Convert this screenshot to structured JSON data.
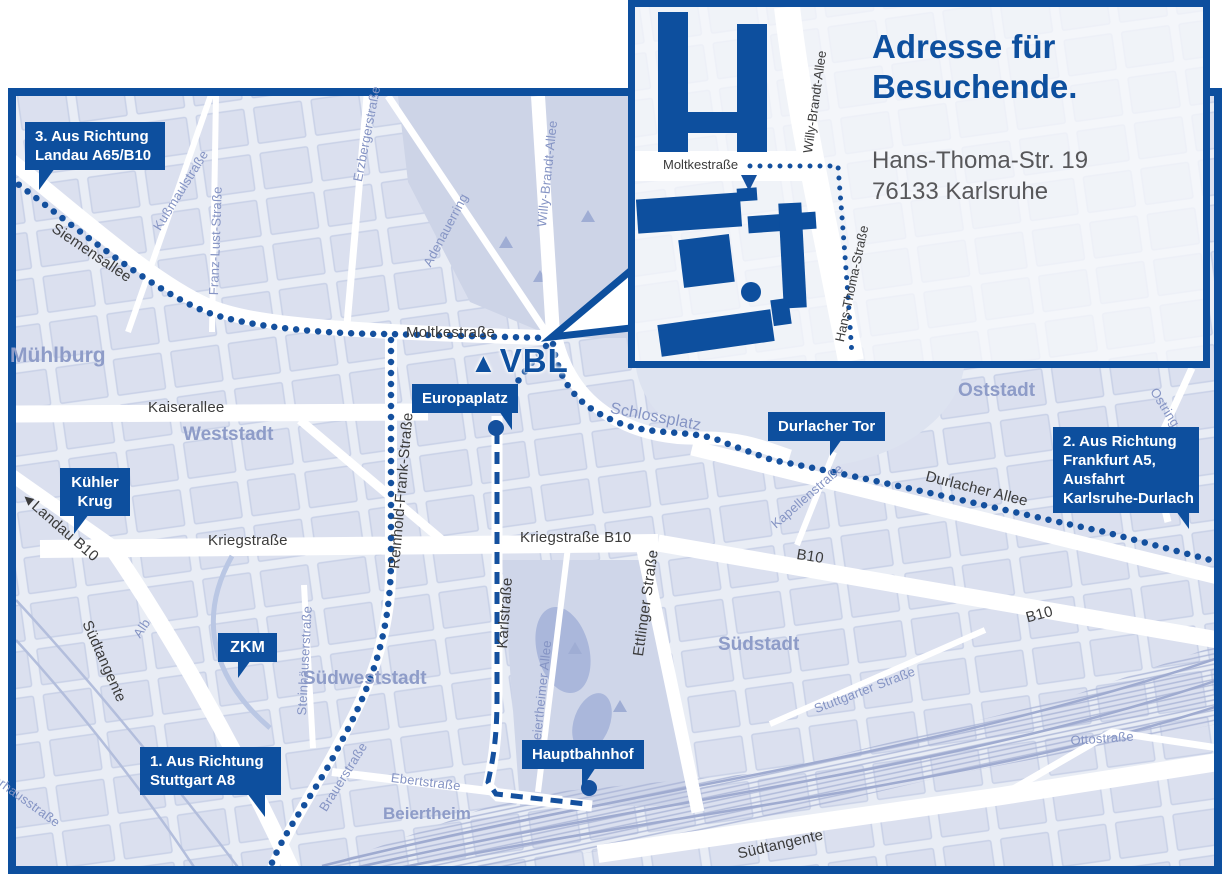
{
  "colors": {
    "primary": "#0d4f9e",
    "route_dots": "#14509e",
    "map_background": "#e9edf5",
    "district_text": "#8e9cc8"
  },
  "inset": {
    "title": [
      "Adresse für",
      "Besuchende."
    ],
    "address": [
      "Hans-Thoma-Str. 19",
      "76133 Karlsruhe"
    ],
    "streets": {
      "moltkestrasse": "Moltkestraße",
      "willy_brandt_allee": "Willy-Brandt-Allee",
      "hans_thoma_strasse": "Hans-Thoma-Straße"
    }
  },
  "logo": {
    "text": "VBL"
  },
  "badges": {
    "route3": {
      "lines": [
        "3. Aus Richtung",
        "Landau A65/B10"
      ]
    },
    "route2": {
      "lines": [
        "2. Aus Richtung",
        "Frankfurt A5,",
        "Ausfahrt",
        "Karlsruhe-Durlach"
      ]
    },
    "route1": {
      "lines": [
        "1. Aus Richtung",
        "Stuttgart A8"
      ]
    },
    "kuehler_krug": {
      "lines": [
        "Kühler",
        "Krug"
      ]
    },
    "zkm": {
      "lines": [
        "ZKM"
      ]
    },
    "europaplatz": {
      "lines": [
        "Europaplatz"
      ]
    },
    "durlacher_tor": {
      "lines": [
        "Durlacher Tor"
      ]
    },
    "hauptbahnhof": {
      "lines": [
        "Hauptbahnhof"
      ]
    }
  },
  "streets": {
    "siemensallee": "Siemensallee",
    "kussmaulstrasse": "Kußmaulstraße",
    "franz_lust_strasse": "Franz-Lust-Straße",
    "erzbergerstrasse": "Erzbergerstraße",
    "willy_brandt_allee": "Willy-Brandt-Allee",
    "adenauerring": "Adenauerring",
    "moltkestrasse": "Moltkestraße",
    "kaiserallee": "Kaiserallee",
    "reinhold_frank_strasse": "Reinhold-Frank-Straße",
    "kriegstrasse": "Kriegstraße",
    "kriegstrasse_b10": "Kriegstraße B10",
    "karlstrasse": "Karlstraße",
    "ettlinger_strasse": "Ettlinger Straße",
    "beiertheimer_allee": "Beiertheimer Allee",
    "steinhaeuserstrasse": "Steinhäuserstraße",
    "brauerstrasse": "Brauerstraße",
    "ebertstrasse": "Ebertstraße",
    "kapellenstrasse": "Kapellenstraße",
    "durlacher_allee": "Durlacher Allee",
    "stuttgarter_strasse": "Stuttgarter Straße",
    "ottostrasse": "Ottostraße",
    "pulverhausstrasse": "Pulverhausstraße",
    "ostring": "Ostring",
    "schlossplatz": "Schlossplatz",
    "alb": "Alb"
  },
  "roads": {
    "landau_b10": "Landau B10",
    "b10": "B10",
    "suedtangente": "Südtangente"
  },
  "districts": {
    "muehlburg": "Mühlburg",
    "weststadt": "Weststadt",
    "oststadt": "Oststadt",
    "suedstadt": "Südstadt",
    "suedweststadt": "Südweststadt",
    "beiertheim": "Beiertheim"
  },
  "icons": {
    "landau_arrow": "◄",
    "vbl_triangle": "▲"
  }
}
